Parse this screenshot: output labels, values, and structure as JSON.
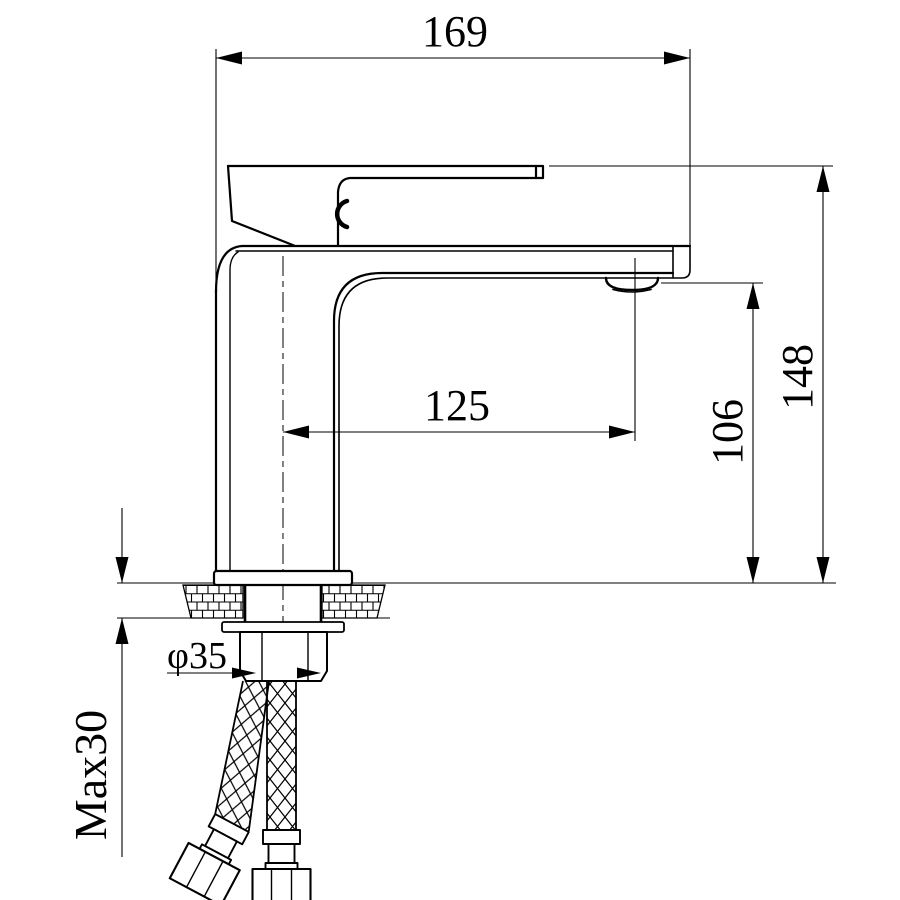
{
  "drawing": {
    "type": "faucet-technical-dimension-drawing",
    "background_color": "#ffffff",
    "line_color": "#000000",
    "dimensions": {
      "overall_width": "169",
      "overall_height": "148",
      "spout_outlet_height": "106",
      "spout_reach": "125",
      "shank_diameter": "φ35",
      "max_mounting_thickness": "Max30"
    }
  }
}
